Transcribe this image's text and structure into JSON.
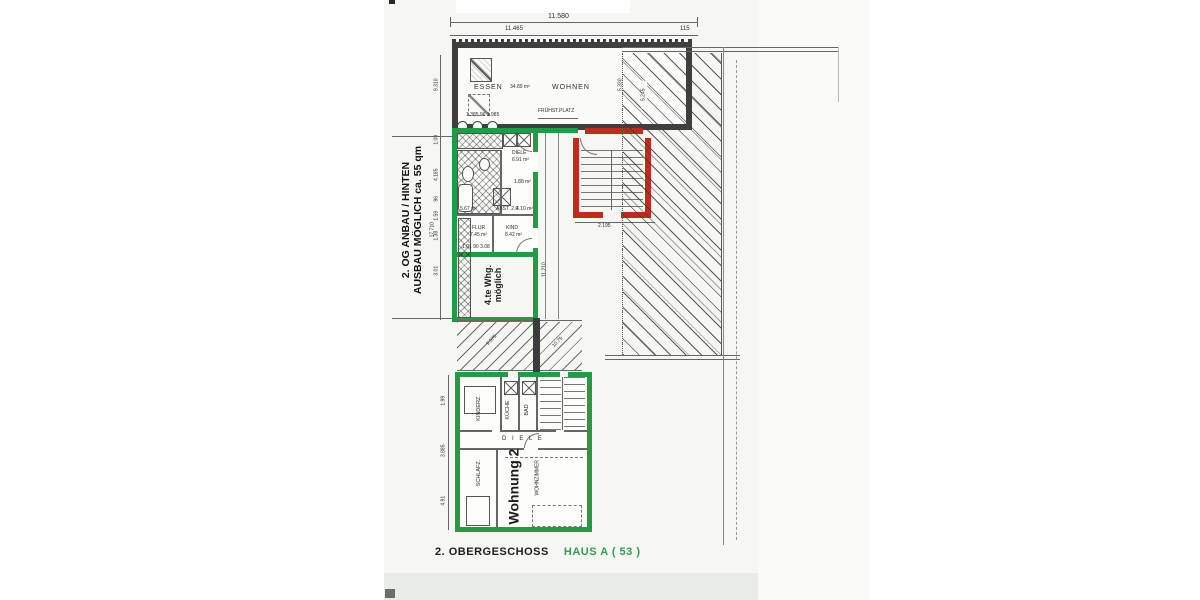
{
  "caption": {
    "black": "2. OBERGESCHOSS",
    "green": "HAUS  A  ( 53 )"
  },
  "side_note": {
    "line1": "2. OG ANBAU / HINTEN",
    "line2": "AUSBAU MÖGLICH  ca. 55 qm",
    "span_dim": "17.710"
  },
  "top_dims": {
    "total": "11.580",
    "sub": "11.465",
    "right": "115"
  },
  "living": {
    "essen": "ESSEN",
    "essen_area": "34.89 m²",
    "wohnen": "WOHNEN",
    "depth_dim": "5.330",
    "breakfast": "FRÜHST.PLATZ",
    "sub_dims": "1.385   96   1.985"
  },
  "flat3": {
    "diele": "DIELE",
    "diele_area": "6.91 m²",
    "bath_area": "1.88 m²",
    "small_area": "5.67 m²",
    "abst": "ABST. 2.0",
    "abst_area": "4.10 m²",
    "flur": "FLUR",
    "flur_area": "7.45 m²",
    "kind": "KIND",
    "kind_area": "8.42 m²",
    "dims_row": "1.01      90      3.08",
    "new_flat_line1": "4.te Whg.",
    "new_flat_line2": "möglich",
    "right_dim": "11.210"
  },
  "stairs": {
    "width_dim": "2.195"
  },
  "hatch": {
    "v_dim": "5.245",
    "diag1": "9.575",
    "diag2": "10.75"
  },
  "chain_upper": [
    "9.310",
    "1.09",
    "4.185",
    "96",
    "1.59",
    "1.38",
    "3.01"
  ],
  "chain_lower": [
    "1.99",
    "3.885",
    "4.91"
  ],
  "flat2": {
    "name": "Wohnung 2",
    "kinderz": "KINDERZ.",
    "kueche": "KÜCHE",
    "bad": "BAD",
    "diele": "D I E L E",
    "schlafz": "SCHLAFZ.",
    "wohnz": "WOHNZIMMER"
  },
  "colors": {
    "green": "#1f9c44",
    "red": "#c4291b",
    "wall": "#3c3c3c",
    "caption_green": "#2f9e52"
  }
}
